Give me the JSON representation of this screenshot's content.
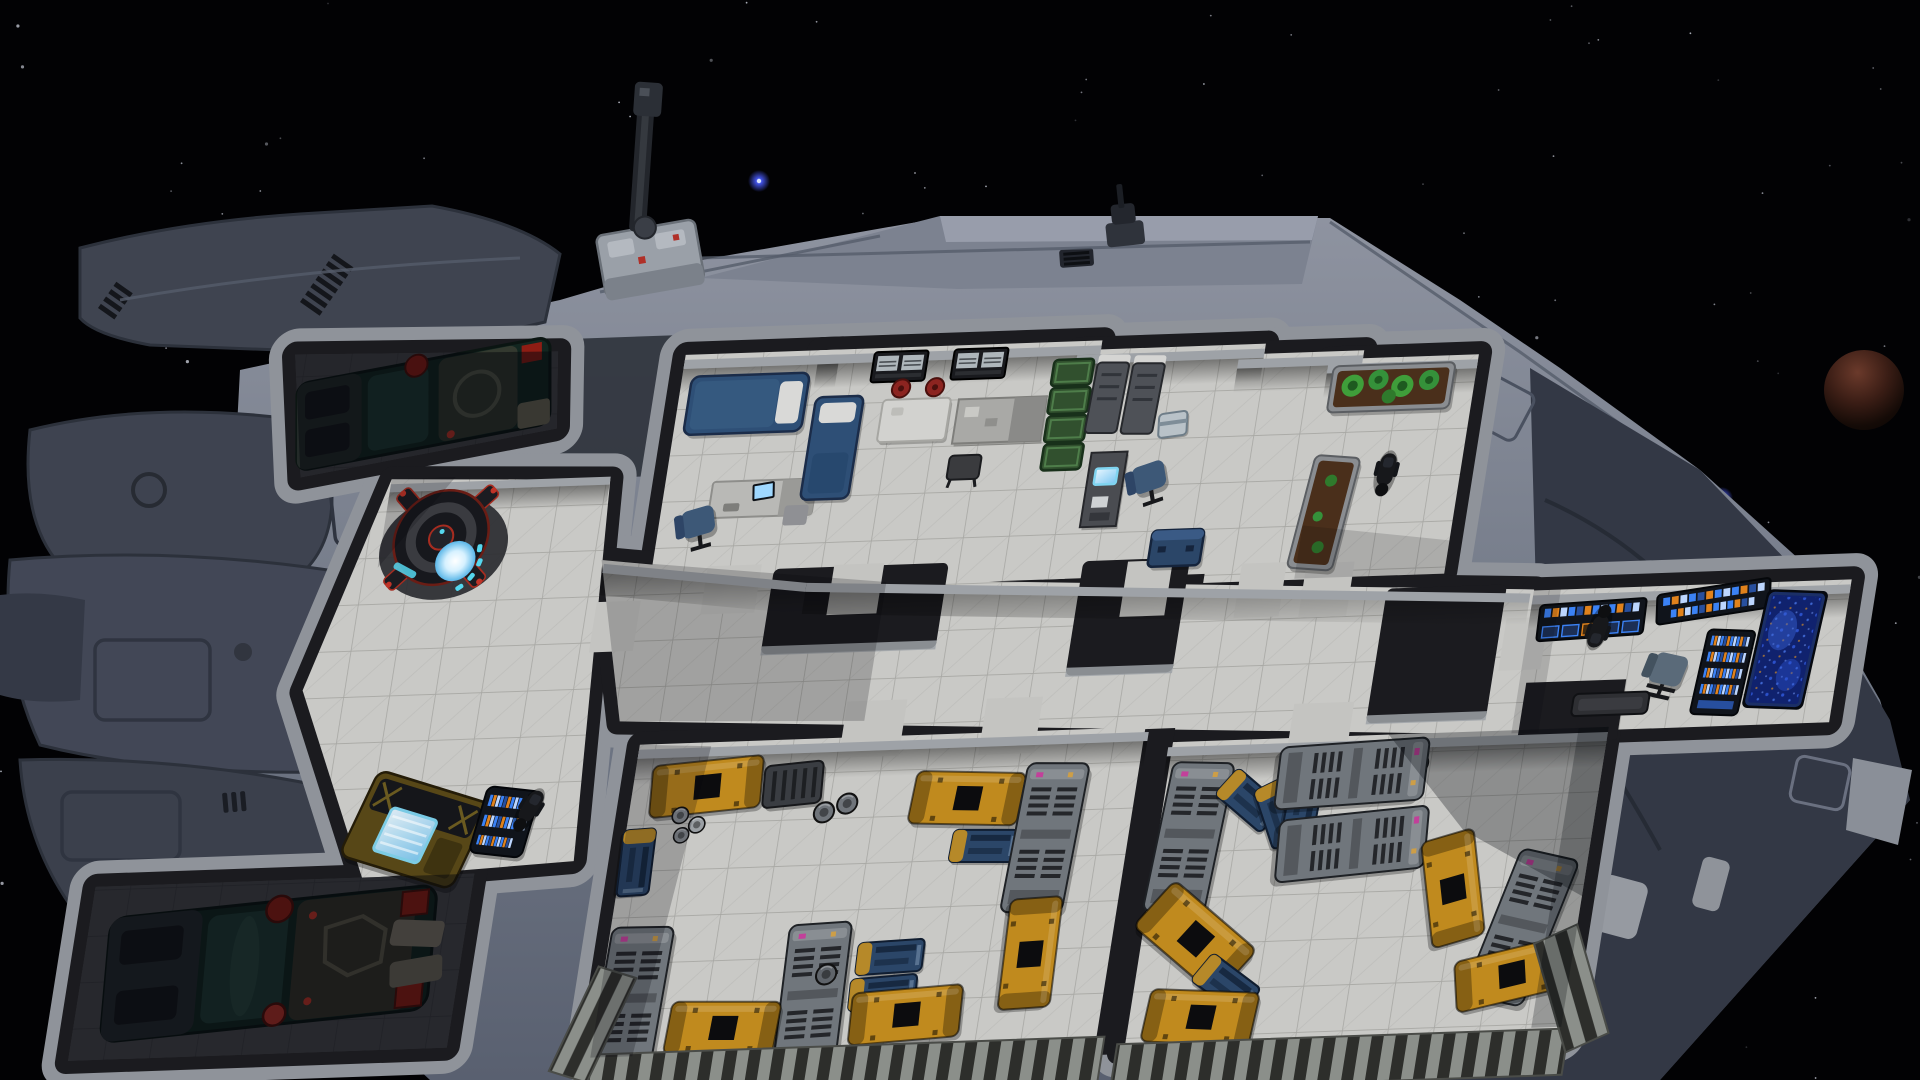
{
  "meta": {
    "app": "spaceship-simulation-game",
    "view": "ship-interior-cutaway-over-space",
    "hud_text_visible": false
  },
  "palette": {
    "space": "#020204",
    "star": "#cdd1dd",
    "blueStar": "#4a5cff",
    "planetLit": "#6b3a2b",
    "planetMid": "#3a1d15",
    "planetDark": "#0a0504",
    "hullLight": "#8e93a0",
    "hullMid": "#707785",
    "hullDark": "#3e4350",
    "hullDeep": "#333845",
    "panelLine": "#555c6a",
    "rim": "#8f939a",
    "wall": "#1b1b1f",
    "wallFace": "#9ea2a7",
    "floor": "#c9c9c6",
    "floorLine": "#a7a7a3",
    "floorPlain": "#c4c4c1",
    "floorDark": "#47474b",
    "floorDarkLine": "#3b3b3f",
    "engineTeal": "#1f3b34",
    "engineTealDark": "#122620",
    "engineGray": "#6f6a58",
    "engineRed": "#8e1d14",
    "reactorBody": "#17181d",
    "reactorRed": "#a62c20",
    "reactorGlow": "#d6f1ff",
    "reactorCyan": "#55d7ee",
    "machineGold": "#574717",
    "machineDark": "#15161a",
    "screenGlow": "#bfe9ff",
    "consoleDark": "#10141b",
    "consoleBlue": "#3b82f5",
    "consoleOrange": "#e0821c",
    "starmapBase": "#10226e",
    "starmapGlow": "#2e55d4",
    "bedBlue": "#2e4f76",
    "pillow": "#d9d9d7",
    "deskGray": "#b9b9b6",
    "chairBlue": "#3d5877",
    "stoolRed": "#8c2420",
    "tableWhite": "#d2d2cf",
    "counterGray": "#a9a9a6",
    "shelfGreen": "#31502e",
    "cabinetGray": "#4e5157",
    "cabinetTop": "#d5d5d3",
    "coolerWhite": "#b9c2c8",
    "plantSoil": "#4a2f1b",
    "plantGreen": "#3f9e3a",
    "crateYellow": "#c08a1e",
    "crateBlue": "#2b4668",
    "crateGray": "#70767c",
    "crateDark": "#3a3d42",
    "catwalk": "#8b8f8a",
    "catwalkSlat": "#2d2e2b",
    "figure": "#17181b"
  },
  "background": {
    "stars": {
      "count": 240,
      "seed": 7
    },
    "blue_stars": [
      {
        "x": 759,
        "y": 181
      },
      {
        "x": 1722,
        "y": 498
      }
    ],
    "planet": {
      "cx": 1864,
      "cy": 390,
      "r": 40
    }
  },
  "ship": {
    "turrets": [
      {
        "id": "dorsal-crane-turret",
        "x": 640,
        "y": 200
      },
      {
        "id": "dorsal-point-turret",
        "x": 1122,
        "y": 212
      }
    ],
    "rooms": [
      {
        "id": "aft-engine-room",
        "lit": false,
        "objects": [
          "fusion-engine"
        ]
      },
      {
        "id": "reactor-machine-room",
        "lit": true,
        "objects": [
          "reactor",
          "fabricator-machine",
          "control-pedestal"
        ],
        "crew": 1
      },
      {
        "id": "crew-cabin",
        "lit": true,
        "objects": [
          "bed",
          "desk-computer",
          "office-chair"
        ]
      },
      {
        "id": "mess-room",
        "lit": true,
        "objects": [
          "bed",
          "dining-table",
          "stool",
          "stool",
          "wall-monitors",
          "counter",
          "green-shelf"
        ]
      },
      {
        "id": "storage-office",
        "lit": true,
        "objects": [
          "locker",
          "locker",
          "cooler-box",
          "desk-computer",
          "office-chair",
          "blue-crate"
        ]
      },
      {
        "id": "empty-room",
        "lit": true,
        "objects": []
      },
      {
        "id": "hydroponics",
        "lit": true,
        "objects": [
          "planter-bed",
          "planter-bed"
        ],
        "crew": 1
      },
      {
        "id": "corridor",
        "lit": true,
        "objects": []
      },
      {
        "id": "bridge",
        "lit": true,
        "objects": [
          "console-bank",
          "console-bank",
          "side-console",
          "starmap-display",
          "pilot-chair",
          "low-table"
        ],
        "crew": 1
      },
      {
        "id": "port-cargo-bay",
        "lit": true
      },
      {
        "id": "starboard-cargo-bay",
        "lit": true
      },
      {
        "id": "fore-engine-room",
        "lit": false,
        "objects": [
          "fusion-engine"
        ]
      }
    ],
    "cargo_inventory": {
      "yellow_containers": 9,
      "blue_containers": 7,
      "gray_containers": 7,
      "dark_crates": 1,
      "barrels": 7
    },
    "crew_visible": 3
  }
}
